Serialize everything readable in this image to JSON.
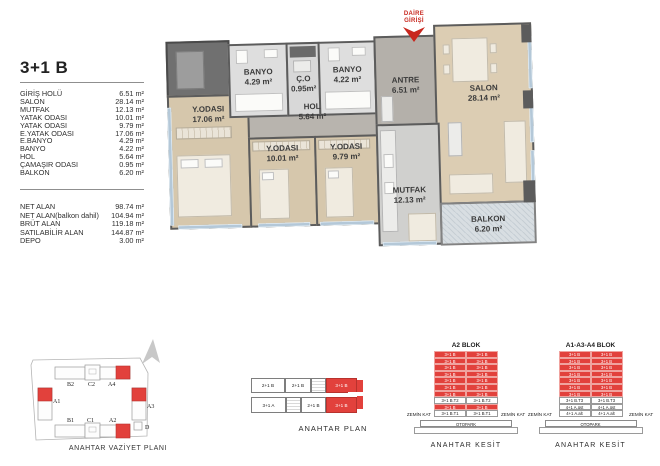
{
  "unit_info": {
    "title": "3+1 B",
    "rooms": [
      {
        "label": "GİRİŞ HOLÜ",
        "value": "6.51 m²"
      },
      {
        "label": "SALON",
        "value": "28.14 m²"
      },
      {
        "label": "MUTFAK",
        "value": "12.13 m²"
      },
      {
        "label": "YATAK ODASI",
        "value": "10.01 m²"
      },
      {
        "label": "YATAK ODASI",
        "value": "9.79 m²"
      },
      {
        "label": "E.YATAK ODASI",
        "value": "17.06 m²"
      },
      {
        "label": "E.BANYO",
        "value": "4.29 m²"
      },
      {
        "label": "BANYO",
        "value": "4.22 m²"
      },
      {
        "label": "HOL",
        "value": "5.64 m²"
      },
      {
        "label": "ÇAMAŞIR ODASI",
        "value": "0.95 m²"
      },
      {
        "label": "BALKON",
        "value": "6.20 m²"
      }
    ],
    "totals": [
      {
        "label": "NET ALAN",
        "value": "98.74 m²"
      },
      {
        "label": "NET ALAN(balkon dahil)",
        "value": "104.94 m²"
      },
      {
        "label": "BRÜT ALAN",
        "value": "119.18 m²"
      },
      {
        "label": "SATILABİLİR ALAN",
        "value": "144.87 m²"
      },
      {
        "label": "DEPO",
        "value": "3.00 m²"
      }
    ]
  },
  "floor_plan": {
    "entrance": {
      "line1": "DAİRE",
      "line2": "GİRİŞİ"
    },
    "rooms": {
      "ebanyo": {
        "name": "BANYO",
        "area": "4.29 m²"
      },
      "camasir": {
        "name": "Ç.O",
        "area": "0.95m²"
      },
      "banyo": {
        "name": "BANYO",
        "area": "4.22 m²"
      },
      "antre": {
        "name": "ANTRE",
        "area": "6.51 m²"
      },
      "salon": {
        "name": "SALON",
        "area": "28.14 m²"
      },
      "eyatak": {
        "name": "Y.ODASI",
        "area": "17.06 m²"
      },
      "hol": {
        "name": "HOL",
        "area": "5.64 m²"
      },
      "yatak1": {
        "name": "Y.ODASI",
        "area": "10.01 m²"
      },
      "yatak2": {
        "name": "Y.ODASI",
        "area": "9.79 m²"
      },
      "mutfak": {
        "name": "MUTFAK",
        "area": "12.13 m²"
      },
      "balkon": {
        "name": "BALKON",
        "area": "6.20 m²"
      }
    }
  },
  "site_plan": {
    "caption": "ANAHTAR VAZİYET PLANI",
    "blocks": {
      "b2": "B2",
      "c2": "C2",
      "a4": "A4",
      "a1": "A1",
      "a3": "A3",
      "b1": "B1",
      "c1": "C1",
      "a2": "A2",
      "d": "D"
    }
  },
  "key_plan": {
    "caption": "ANAHTAR PLAN",
    "units": [
      "2+1 B",
      "2+1 B",
      "3+1 B",
      "3+1 A",
      "2+1 B",
      "3+1 B"
    ]
  },
  "sections": [
    {
      "title": "A2 BLOK",
      "ground_left": "ZEMİN KAT",
      "ground_right": "ZEMİN KAT",
      "basement": "OTOPARK",
      "caption": "ANAHTAR KESİT",
      "rows": [
        {
          "left": "3+1 B",
          "right": "3+1 B",
          "highlight": true
        },
        {
          "left": "3+1 B",
          "right": "3+1 B",
          "highlight": true
        },
        {
          "left": "3+1 B",
          "right": "3+1 B",
          "highlight": true
        },
        {
          "left": "3+1 B",
          "right": "3+1 B",
          "highlight": true
        },
        {
          "left": "3+1 B",
          "right": "3+1 B",
          "highlight": true
        },
        {
          "left": "3+1 B",
          "right": "3+1 B",
          "highlight": true
        },
        {
          "left": "3+1 B",
          "right": "3+1 B",
          "highlight": true
        },
        {
          "left": "3+1 B.T2",
          "right": "3+1 B.T2",
          "highlight": false
        },
        {
          "left": "3+1 B",
          "right": "3+1 B",
          "highlight": true
        },
        {
          "left": "3+1 B.T1",
          "right": "3+1 B.T1",
          "highlight": false
        }
      ]
    },
    {
      "title": "A1-A3-A4 BLOK",
      "ground_left": "ZEMİN KAT",
      "ground_right": "ZEMİN KAT",
      "basement": "OTOPARK",
      "caption": "ANAHTAR KESİT",
      "rows": [
        {
          "left": "3+1 B",
          "right": "3+1 B",
          "highlight": true
        },
        {
          "left": "3+1 B",
          "right": "3+1 B",
          "highlight": true
        },
        {
          "left": "3+1 B",
          "right": "3+1 B",
          "highlight": true
        },
        {
          "left": "3+1 B",
          "right": "3+1 B",
          "highlight": true
        },
        {
          "left": "3+1 B",
          "right": "3+1 B",
          "highlight": true
        },
        {
          "left": "3+1 B",
          "right": "3+1 B",
          "highlight": true
        },
        {
          "left": "3+1 B",
          "right": "3+1 B",
          "highlight": true
        },
        {
          "left": "3+1 B.T3",
          "right": "3+1 B.T3",
          "highlight": false
        },
        {
          "left": "4+1 A.üst",
          "right": "4+1 A.üst",
          "highlight": false
        },
        {
          "left": "4+1 A.alt",
          "right": "4+1 A.alt",
          "highlight": false
        }
      ]
    }
  ],
  "colors": {
    "highlight_red": "#e2413c",
    "entrance_red": "#c8271e",
    "wall_gray": "#5c5c5c",
    "wood_floor": "#d7c8ae",
    "tile_light": "#dcdcdc",
    "tile_gray": "#b7b3ae",
    "window_blue": "#b4c8d8"
  }
}
